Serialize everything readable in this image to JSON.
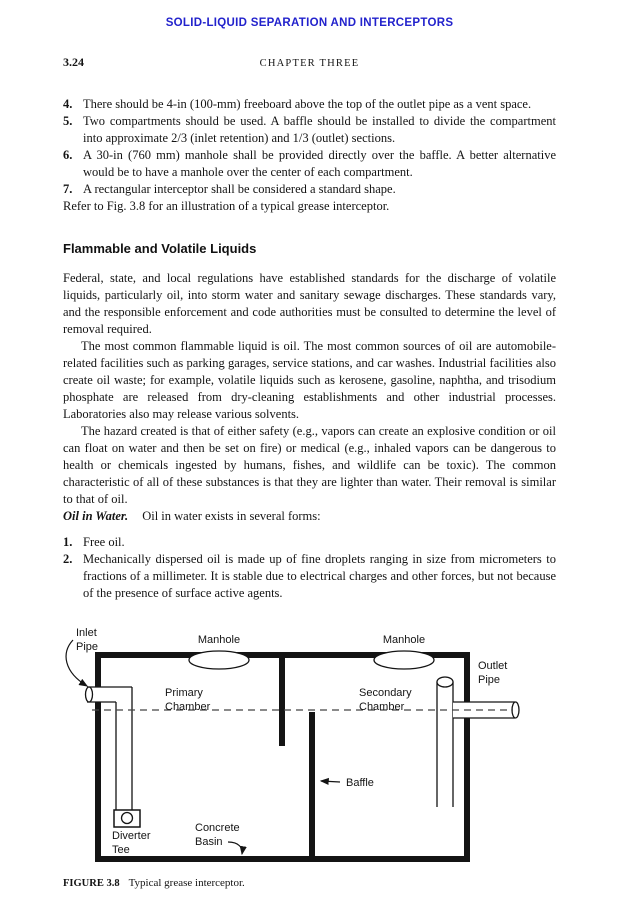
{
  "colors": {
    "header_blue": "#2222cc"
  },
  "header": {
    "running_title": "SOLID-LIQUID SEPARATION AND INTERCEPTORS",
    "page_number": "3.24",
    "chapter_title": "CHAPTER THREE"
  },
  "requirements_list": {
    "items": [
      {
        "number": "4.",
        "text": "There should be 4-in (100-mm) freeboard above the top of the outlet pipe as a vent space."
      },
      {
        "number": "5.",
        "text": "Two compartments should be used. A baffle should be installed to divide the compartment into approximate 2/3 (inlet retention) and 1/3 (outlet) sections."
      },
      {
        "number": "6.",
        "text": "A 30-in (760 mm) manhole shall be provided directly over the baffle. A better alternative would be to have a manhole over the center of each compartment."
      },
      {
        "number": "7.",
        "text": "A rectangular interceptor shall be considered a standard shape."
      }
    ]
  },
  "refer_note": "Refer to Fig. 3.8 for an illustration of a typical grease interceptor.",
  "flammable_section": {
    "heading": "Flammable and Volatile Liquids",
    "paragraphs": [
      "Federal, state, and local regulations have established standards for the discharge of volatile liquids, particularly oil, into storm water and sanitary sewage discharges. These standards vary, and the responsible enforcement and code authorities must be consulted to determine the level of removal required.",
      "The most common flammable liquid is oil. The most common sources of oil are automobile-related facilities such as parking garages, service stations, and car washes. Industrial facilities also create oil waste; for example, volatile liquids such as kerosene, gasoline, naphtha, and trisodium phosphate are released from dry-cleaning establishments and other industrial processes. Laboratories also may release various solvents.",
      "The hazard created is that of either safety (e.g., vapors can create an explosive condition or oil can float on water and then be set on fire) or medical (e.g., inhaled vapors can be dangerous to health or chemicals ingested by humans, fishes, and wildlife can be toxic). The common characteristic of all of these substances is that they are lighter than water. Their removal is similar to that of oil."
    ]
  },
  "oil_in_water": {
    "heading": "Oil in Water.",
    "intro": "Oil in water exists in several forms:",
    "items": [
      {
        "number": "1.",
        "text": "Free oil."
      },
      {
        "number": "2.",
        "text": "Mechanically dispersed oil is made up of fine droplets ranging in size from micrometers to fractions of a millimeter. It is stable due to electrical charges and other forces, but not because of the presence of surface active agents."
      }
    ]
  },
  "figure": {
    "labels": {
      "inlet_pipe": [
        "Inlet",
        "Pipe"
      ],
      "manhole_left": "Manhole",
      "manhole_right": "Manhole",
      "primary_chamber": [
        "Primary",
        "Chamber"
      ],
      "secondary_chamber": [
        "Secondary",
        "Chamber"
      ],
      "outlet_pipe": [
        "Outlet",
        "Pipe"
      ],
      "baffle": "Baffle",
      "diverter_tee": [
        "Diverter",
        "Tee"
      ],
      "concrete_basin": [
        "Concrete",
        "Basin"
      ]
    },
    "caption": {
      "label": "FIGURE 3.8",
      "text": "Typical grease interceptor."
    }
  }
}
